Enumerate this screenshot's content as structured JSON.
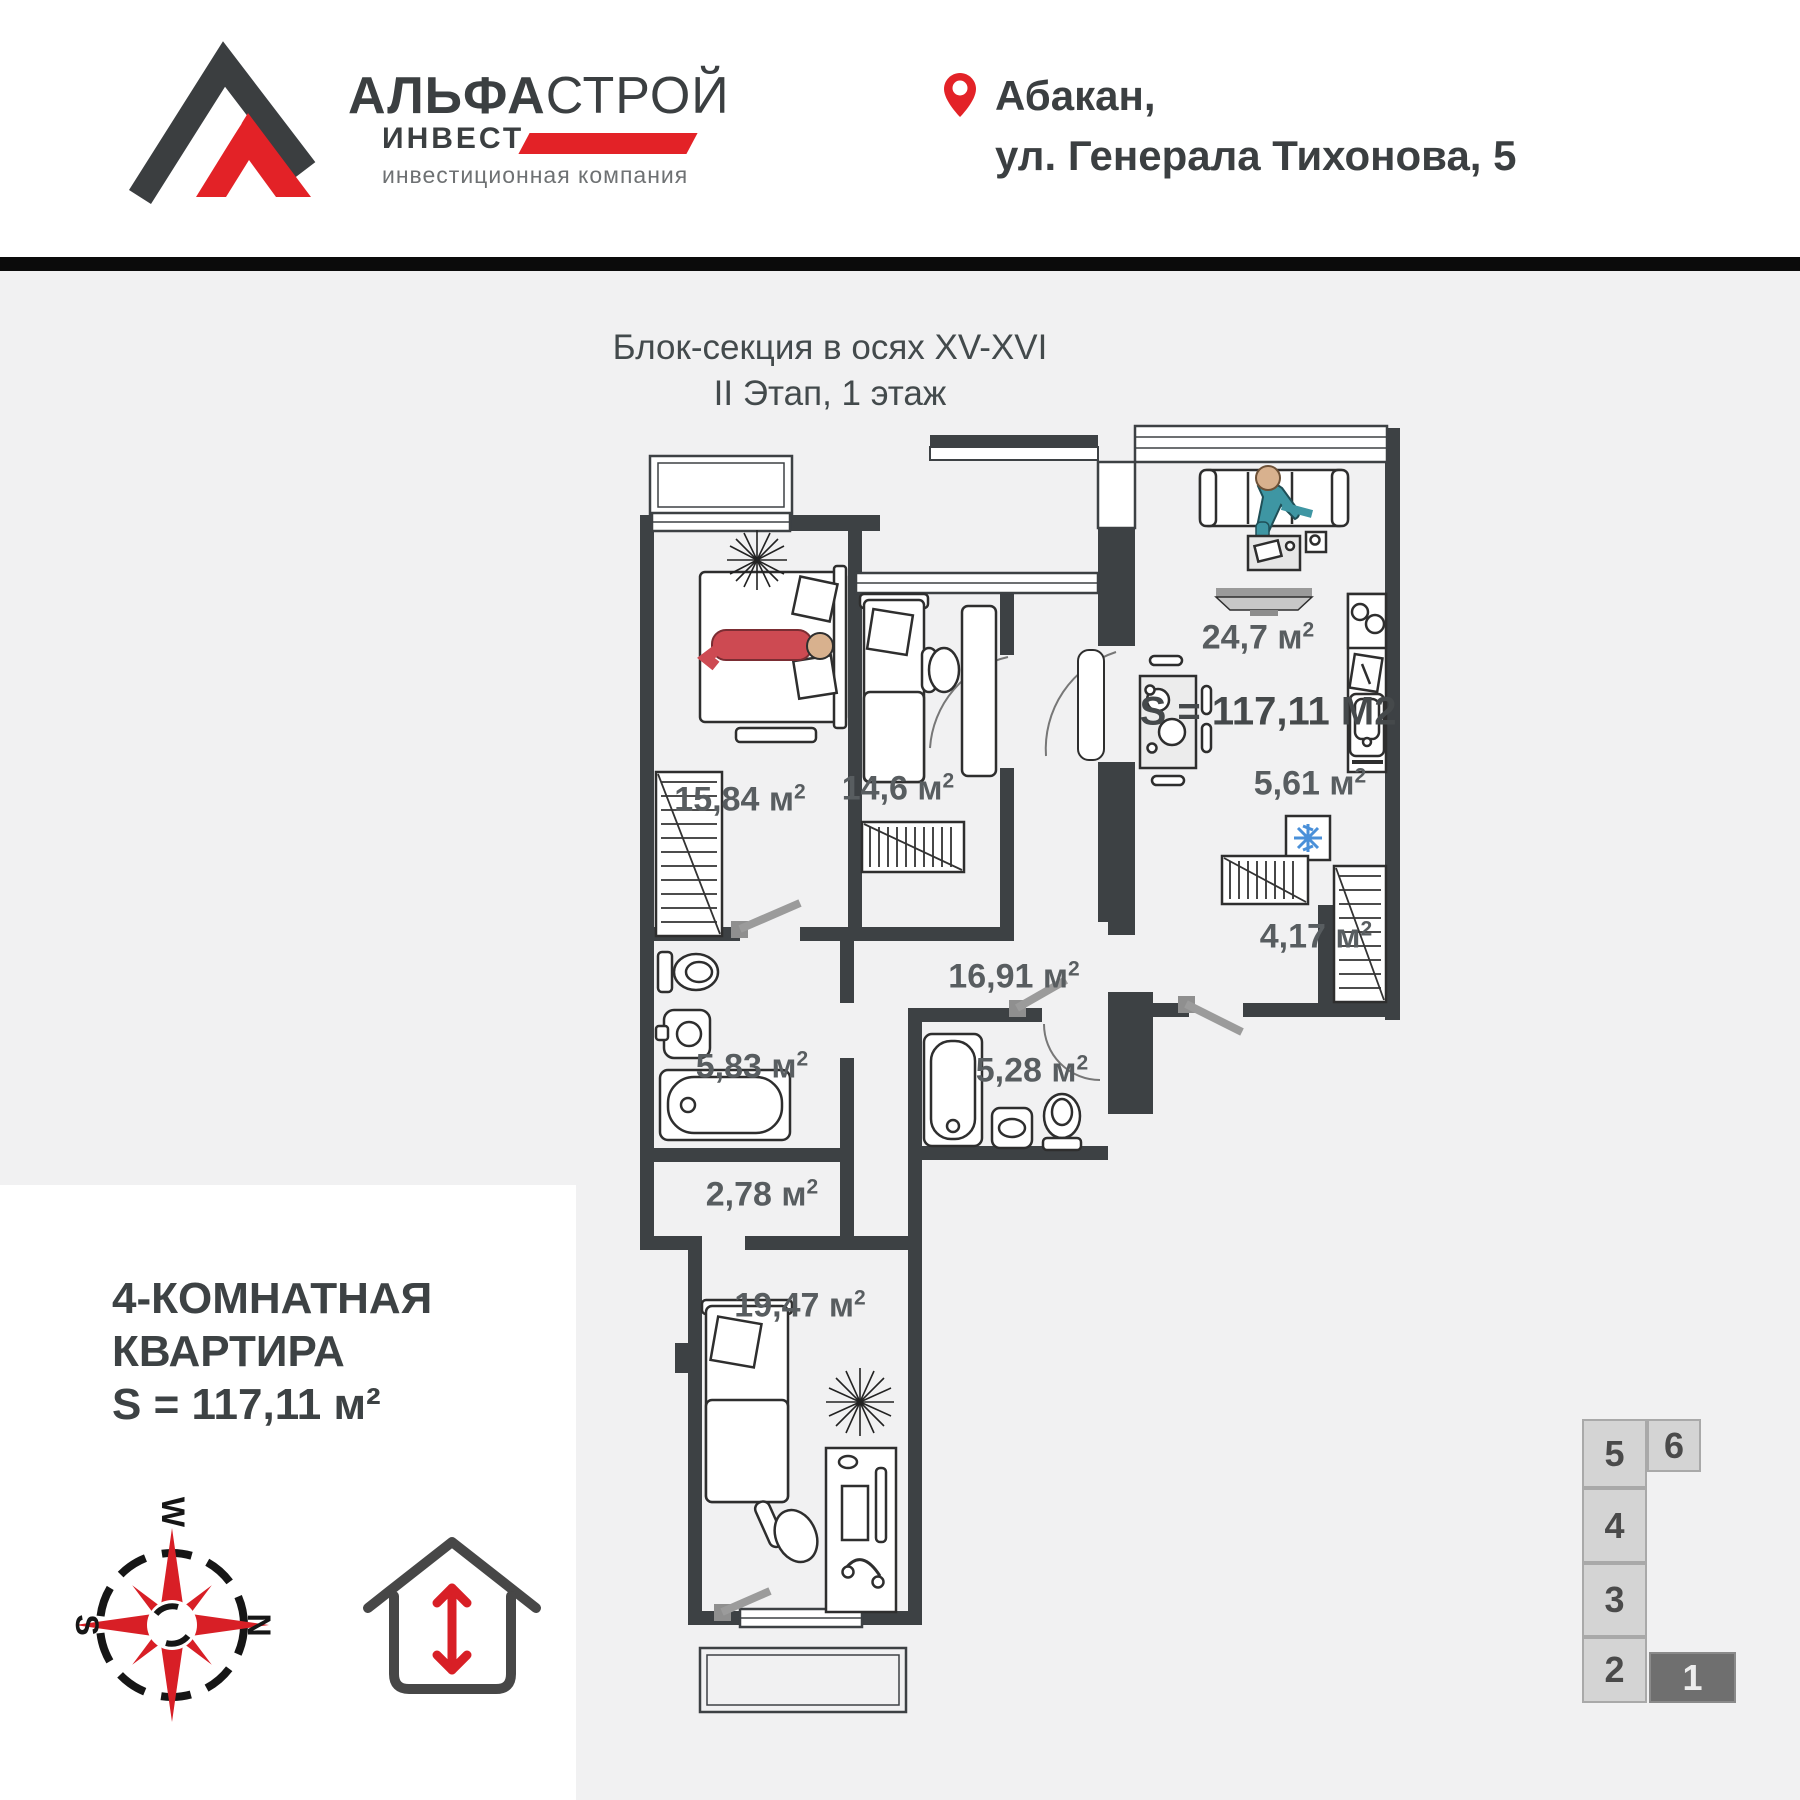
{
  "header": {
    "logo": {
      "title_bold": "АЛЬФА",
      "title_light": "СТРОЙ",
      "line2": "ИНВЕСТ",
      "subtitle": "инвестиционная компания"
    },
    "address": {
      "line1": "Абакан,",
      "line2": "ул. Генерала Тихонова, 5"
    }
  },
  "plan": {
    "title_line1": "Блок-секция в осях XV-XVI",
    "title_line2": "II Этап, 1 этаж",
    "total_area": "S = 117,11 М2",
    "unit": "м",
    "sup": "2",
    "areas": {
      "living": "24,7",
      "kitchen": "5,61",
      "closet": "4,17",
      "bedroom1": "15,84",
      "bedroom2": "14,6",
      "corridor": "16,91",
      "bath1": "5,83",
      "bath2": "5,28",
      "hall": "2,78",
      "bedroom3": "19,47"
    }
  },
  "summary": {
    "line1": "4-КОМНАТНАЯ",
    "line2": "КВАРТИРА",
    "line3": "S = 117,11 м²"
  },
  "compass": {
    "top": "W",
    "right": "N",
    "left": "S"
  },
  "miniplan": {
    "cells": [
      {
        "label": "5",
        "active": false
      },
      {
        "label": "6",
        "active": false
      },
      {
        "label": "4",
        "active": false
      },
      {
        "label": "3",
        "active": false
      },
      {
        "label": "2",
        "active": false
      },
      {
        "label": "1",
        "active": true
      }
    ]
  },
  "colors": {
    "accent_red": "#E32227",
    "wall": "#3D4144",
    "label_gray": "#585D60",
    "bar": "#0B0B0B"
  }
}
